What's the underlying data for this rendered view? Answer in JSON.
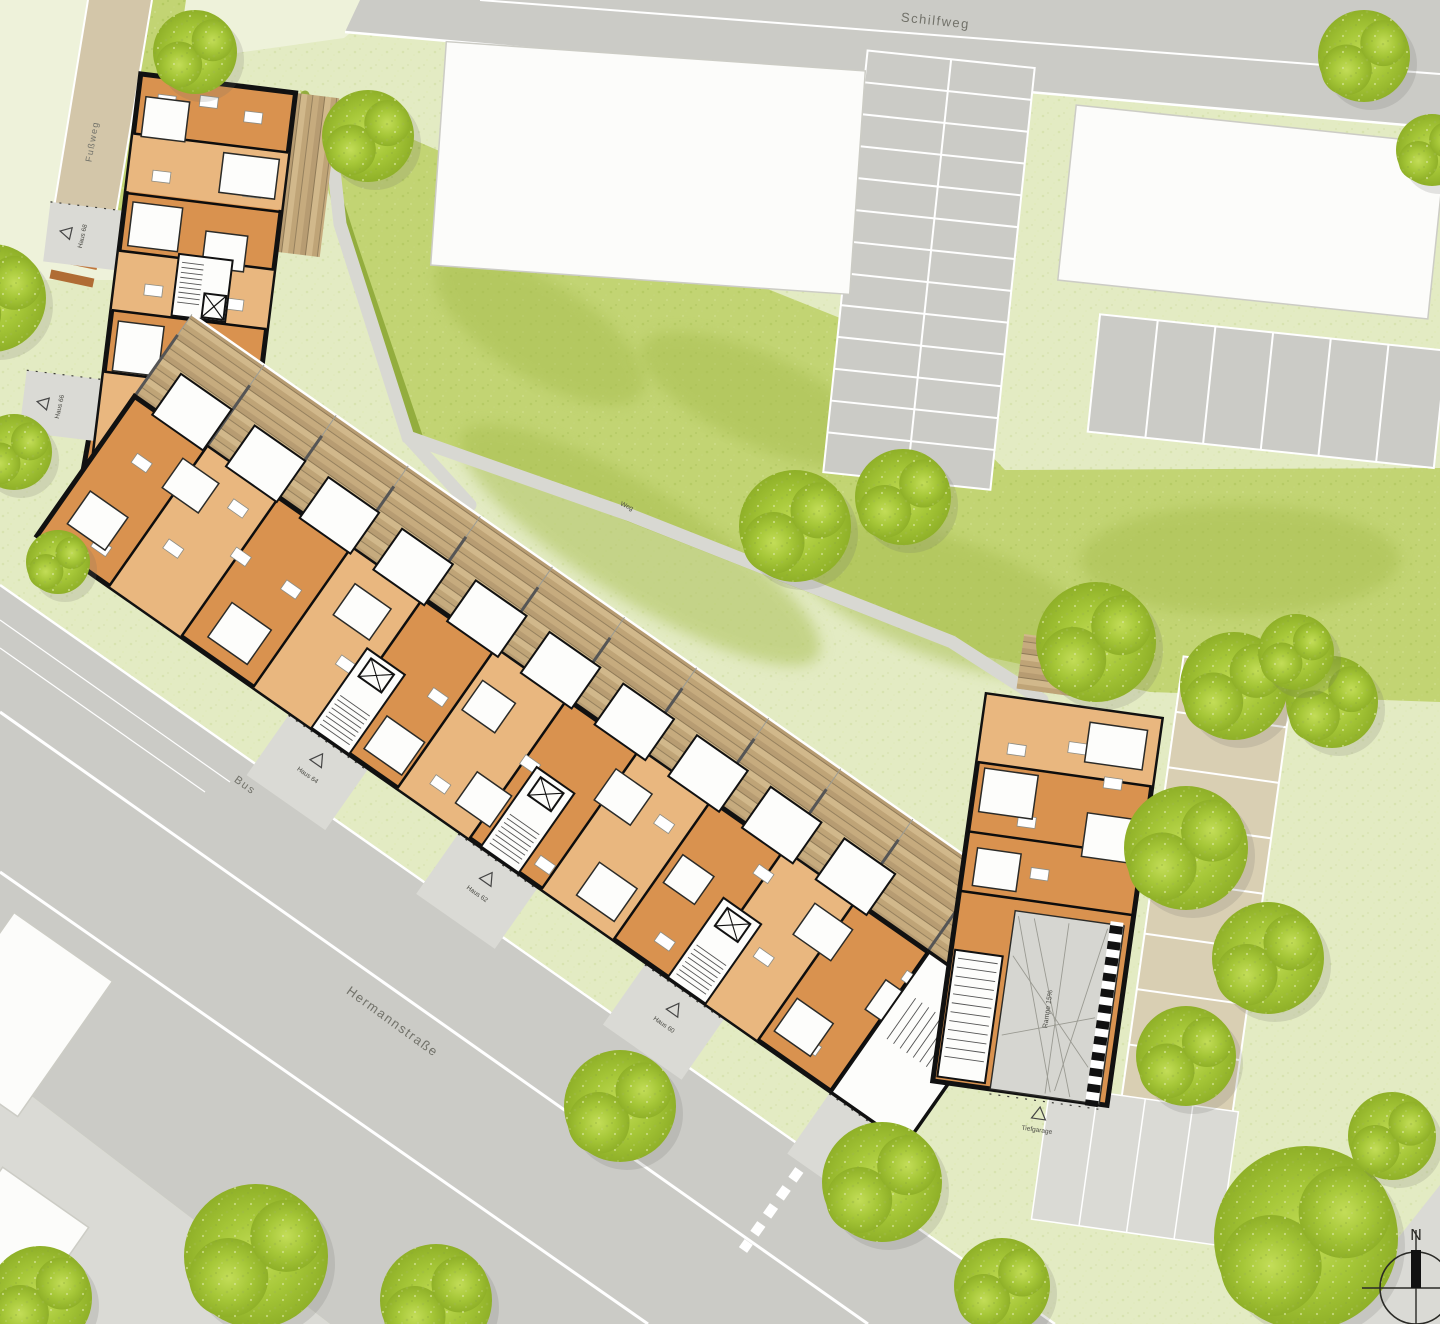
{
  "plan": {
    "streets": {
      "schilfweg": "Schilfweg",
      "fussweg": "Fußweg",
      "bus": "Bus",
      "hermannstrasse": "Hermannstraße",
      "weg": "Weg"
    },
    "houses": [
      {
        "label": "Haus 68"
      },
      {
        "label": "Haus 66"
      },
      {
        "label": "Haus 64"
      },
      {
        "label": "Haus 62"
      },
      {
        "label": "Haus 60"
      },
      {
        "label": "Haus 58"
      }
    ],
    "garage": {
      "ramp": "Rampe 15%",
      "entrance": "Tiefgarage"
    },
    "parking": {
      "visitor": "Besucher"
    },
    "compass": {
      "north": "N"
    },
    "colors": {
      "road": "#cbcbc6",
      "sidewalk": "#dadad5",
      "grass_light": "#e3ebc3",
      "grass_bright": "#c2d473",
      "tree": "#a4c62f",
      "building_orange_dark": "#d9924f",
      "building_orange_light": "#e9b77f",
      "wall_black": "#111111",
      "path_tan": "#d3c6a9",
      "white_building": "#fcfcfa"
    }
  }
}
